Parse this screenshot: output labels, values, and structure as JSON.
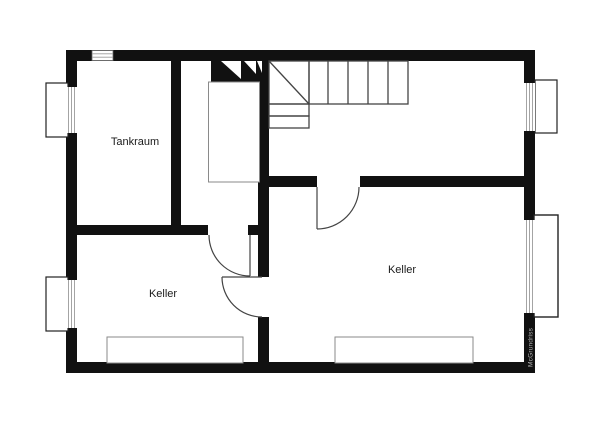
{
  "labels": {
    "room_top_left": "Tankraum",
    "room_bottom_left": "Keller",
    "room_right": "Keller"
  },
  "watermark": {
    "text": "McGrundriss"
  },
  "colors": {
    "wall": "#111111",
    "thin_line": "#444444",
    "light_line": "#8a8a8a",
    "glazing_line": "#9a9a9a",
    "background": "#ffffff",
    "label_text": "#1a1a1a",
    "watermark_text": "#b5b5b5"
  }
}
